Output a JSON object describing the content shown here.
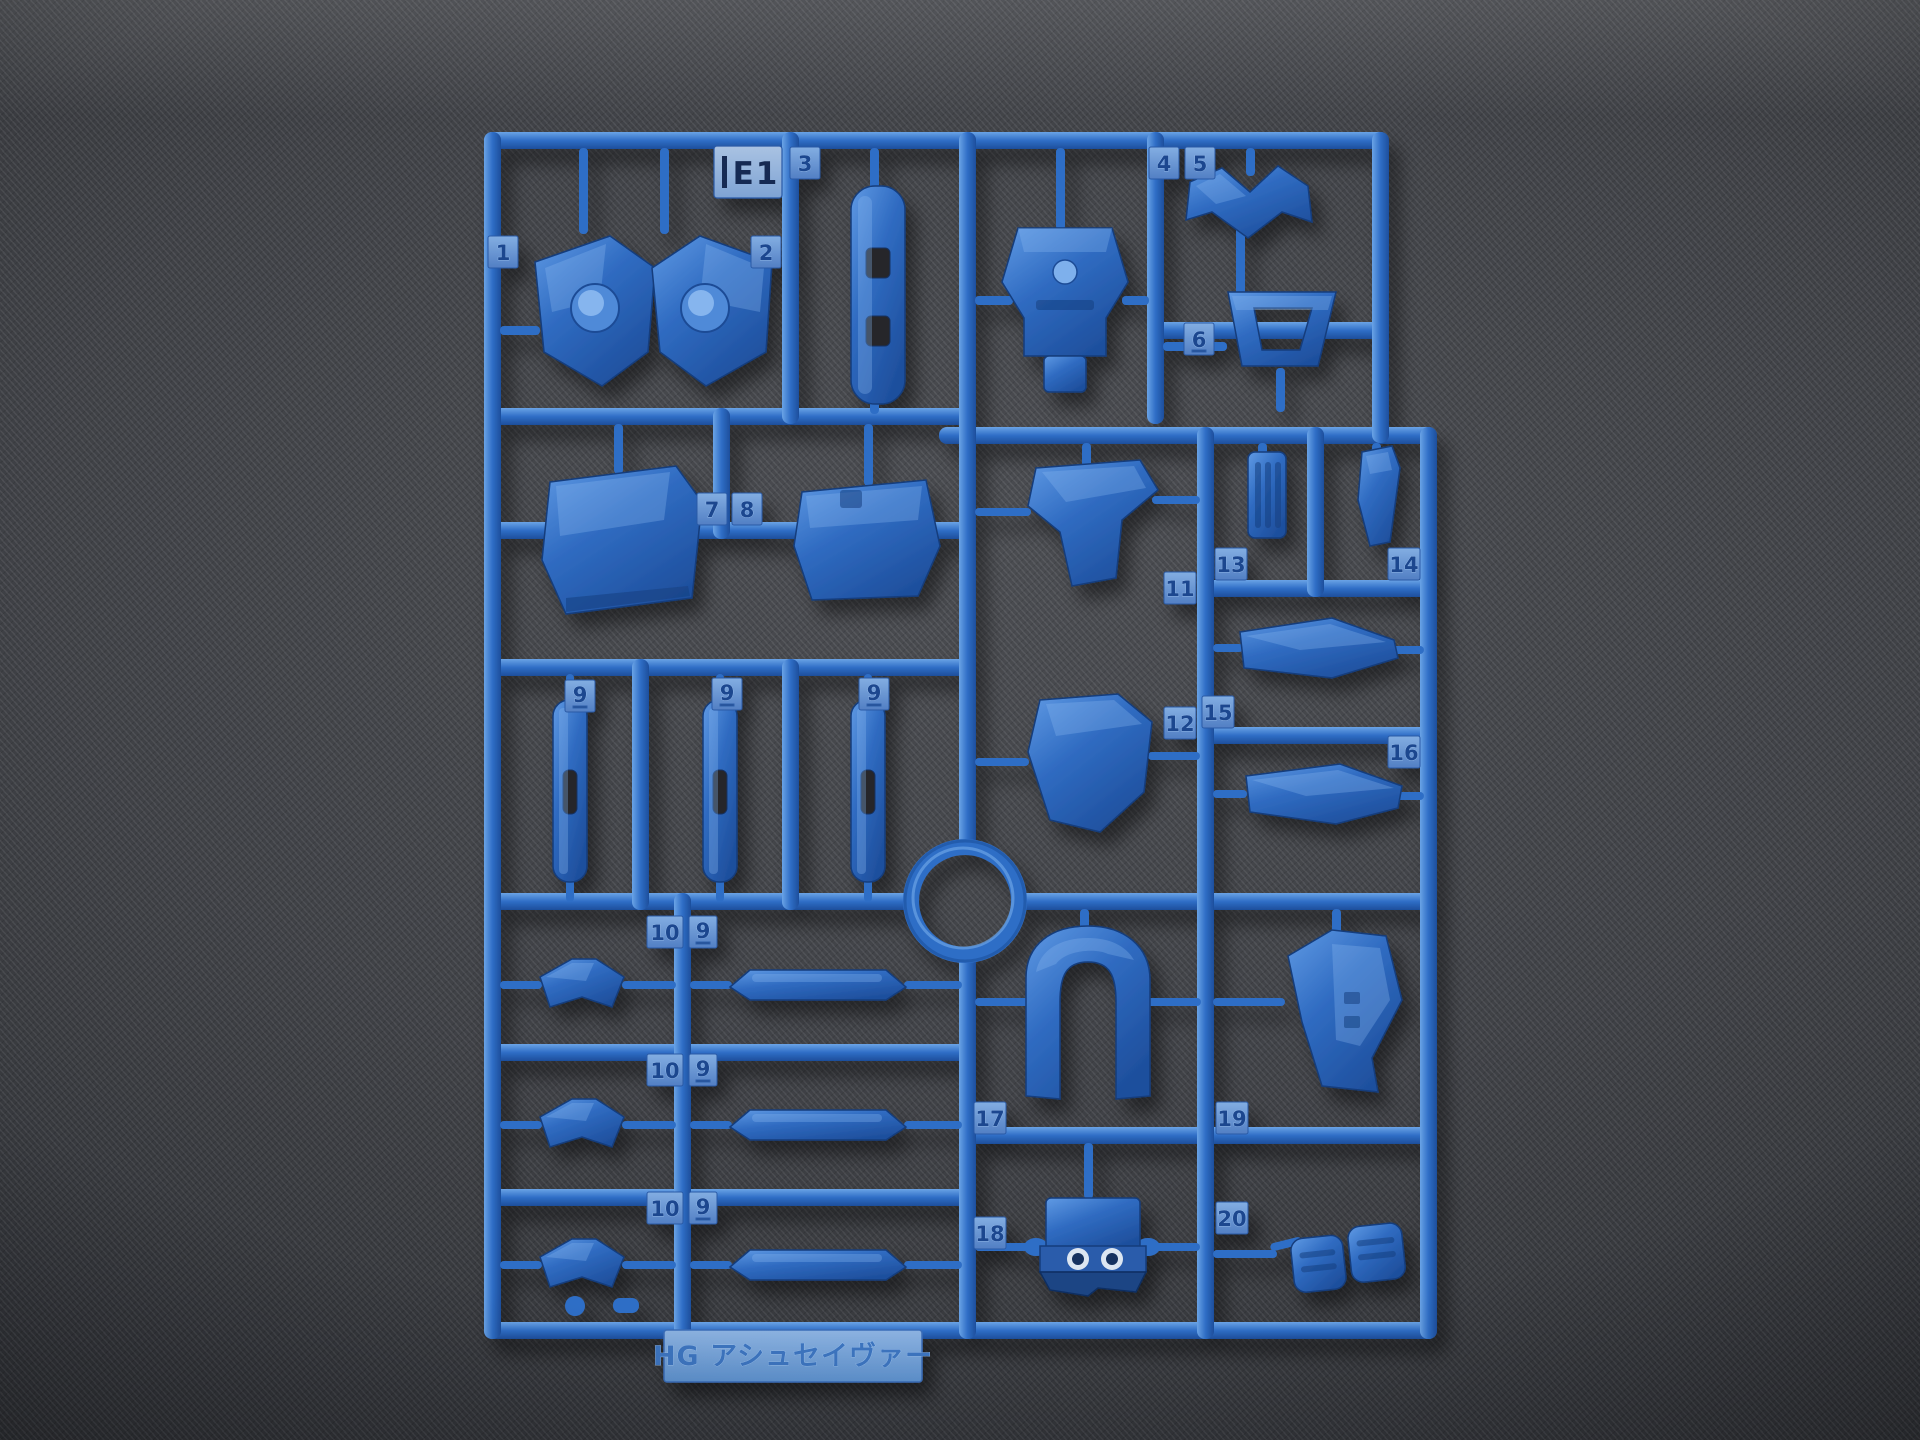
{
  "scene": {
    "description": "Top-down photograph of a blue injection-molded plastic model runner (sprue) lying on dark gray woven fabric",
    "colors": {
      "plastic": "#2f6ec6",
      "plastic_light": "#6aa3e6",
      "plastic_dark": "#1d4e9c",
      "fabric": "#404246"
    }
  },
  "runner": {
    "code": "E1"
  },
  "nameplate": {
    "text": "HG アシュセイヴァー"
  },
  "tags": {
    "n1": "1",
    "n2": "2",
    "n3": "3",
    "n4": "4",
    "n5": "5",
    "n6": "6",
    "n7": "7",
    "n8": "8",
    "n9a": "9",
    "n9b": "9",
    "n9c": "9",
    "r1a": "10",
    "r1b": "9",
    "r2a": "10",
    "r2b": "9",
    "r3a": "10",
    "r3b": "9",
    "n11": "11",
    "n12": "12",
    "n13": "13",
    "n14": "14",
    "n15": "15",
    "n16": "16",
    "n17": "17",
    "n18": "18",
    "n19": "19",
    "n20": "20"
  }
}
